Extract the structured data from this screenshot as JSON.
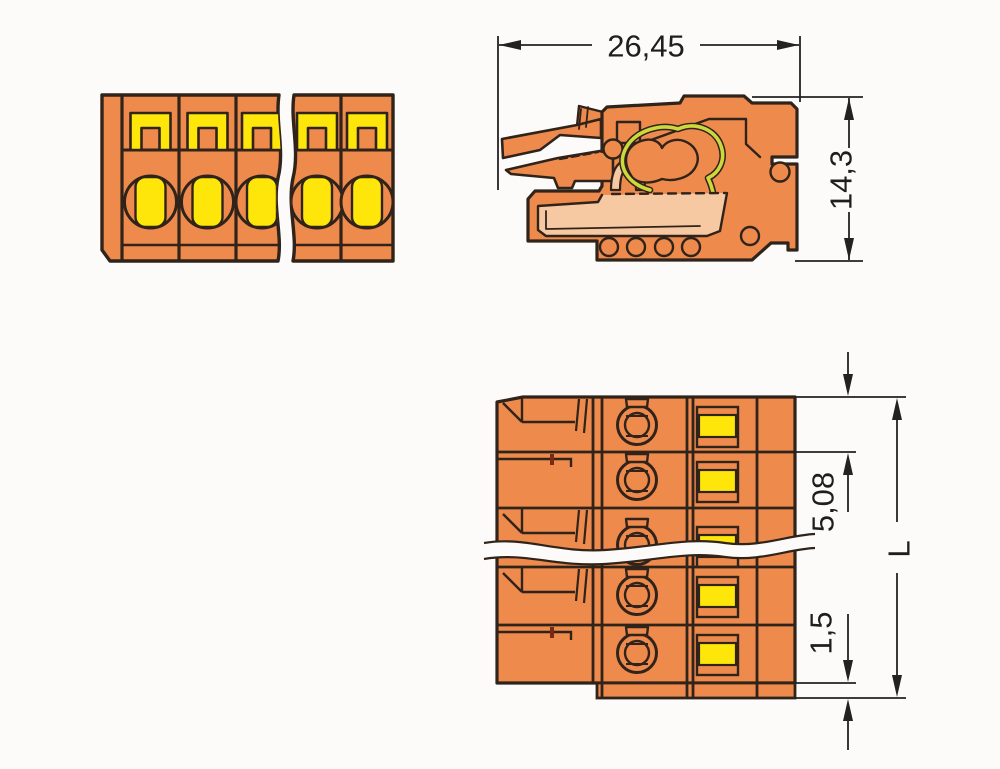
{
  "drawing": {
    "title": "multi-pole connector technical dimension drawing",
    "dimensions": {
      "total_width": "26,45",
      "total_height": "14,3",
      "pole_pitch": "5,08",
      "rear_offset": "1,5",
      "total_length": "L"
    },
    "views": {
      "front": {
        "name": "front view",
        "poles_visible": 5
      },
      "side": {
        "name": "side cross-section view"
      },
      "bottom": {
        "name": "bottom view",
        "rows_visible": 5
      }
    },
    "colors": {
      "body_orange": "#EF8A4D",
      "accent_yellow": "#FFE60A",
      "inner_peach": "#F6C9A2",
      "spring_green": "#CCD83C",
      "marker_red": "#7A2A12",
      "outline": "#30231A",
      "dimension_lines": "#222222",
      "background": "#FCFBFA"
    }
  }
}
